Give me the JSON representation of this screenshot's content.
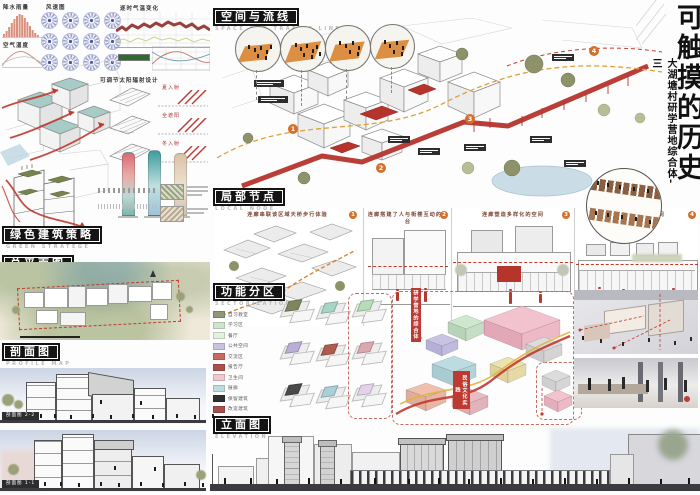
{
  "title_block": {
    "title": "可触摸的历史",
    "subtitle": "大湖塘村研学营地综合体-三"
  },
  "sections": {
    "space": {
      "zh": "空间与流线",
      "en": "SPACE AND TRAFFIC LINE"
    },
    "nodes": {
      "zh": "局部节点",
      "en": "LOCAL NODE"
    },
    "zoning": {
      "zh": "功能分区",
      "en": "SECTORIZATION"
    },
    "elevation": {
      "zh": "立面图",
      "en": "ELEVATION"
    },
    "green": {
      "zh": "绿色建筑策略",
      "en": "GREEN STRATEGE"
    },
    "plan": {
      "zh": "总平面图",
      "en": "OVERALL PLAN"
    },
    "profile": {
      "zh": "剖面图",
      "en": "PROFILE MAP"
    }
  },
  "climate": {
    "precip": "降水雨量",
    "humidity": "空气湿度",
    "windrose": "风速图",
    "temperature": "逐时气温变化"
  },
  "solar": {
    "title": "可调节太阳辐射设计",
    "rows": [
      {
        "label": "夏入射"
      },
      {
        "label": "全遮阳"
      },
      {
        "label": "冬入射"
      }
    ]
  },
  "profile": {
    "labels": [
      "剖面图 2-2",
      "剖面图 1-1"
    ]
  },
  "space": {
    "markers": [
      {
        "num": "1"
      },
      {
        "num": "2"
      },
      {
        "num": "3"
      },
      {
        "num": "4"
      }
    ]
  },
  "nodes": {
    "panels": [
      {
        "num": "1",
        "caption": "连廊串联该区域天桥步行体验"
      },
      {
        "num": "2",
        "caption": "连廊搭建了人与街楼互动的平台"
      },
      {
        "num": "3",
        "caption": "连廊塑造多样化的空间"
      },
      {
        "num": "4",
        "caption": "连廊围合开放式空间"
      }
    ]
  },
  "zoning": {
    "legend": [
      {
        "label": "自习教室",
        "color": "#8f9779"
      },
      {
        "label": "学习区",
        "color": "#cfe4cf"
      },
      {
        "label": "餐厅",
        "color": "#e2f0e0"
      },
      {
        "label": "公共空间",
        "color": "#c9c3e3"
      },
      {
        "label": "交流区",
        "color": "#c96a62"
      },
      {
        "label": "报告厅",
        "color": "#b04f4a"
      },
      {
        "label": "卫生间",
        "color": "#f1c8ce"
      },
      {
        "label": "展廊",
        "color": "#bcdce2"
      },
      {
        "label": "保留建筑",
        "color": "#2f2f2f"
      },
      {
        "label": "改造建筑",
        "color": "#a94f4c"
      },
      {
        "label": "新建建筑",
        "color": "#e9bcc3"
      }
    ],
    "minis": [
      {
        "color": "#7e8660"
      },
      {
        "color": "#a8d4c4"
      },
      {
        "color": "#b7dcb7"
      },
      {
        "color": "#b9aed6"
      },
      {
        "color": "#b05b50"
      },
      {
        "color": "#dba8b0"
      },
      {
        "color": "#4a4a4a"
      },
      {
        "color": "#a9cfd8"
      },
      {
        "color": "#e3d3e8"
      }
    ],
    "tags": [
      {
        "text": "研学营地的综合体"
      },
      {
        "text": "民俗文化实践"
      }
    ]
  }
}
